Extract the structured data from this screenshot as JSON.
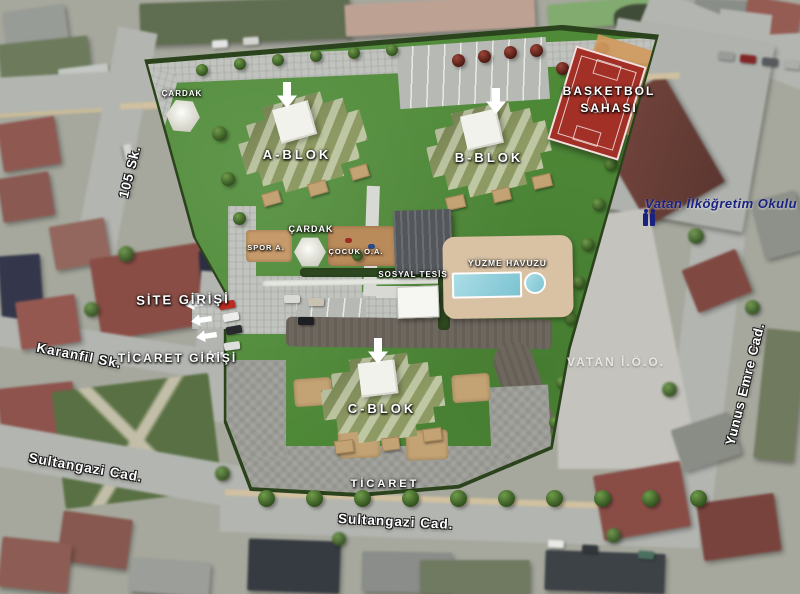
{
  "site_plan": {
    "blocks": [
      {
        "label": "A-BLOK"
      },
      {
        "label": "B-BLOK"
      },
      {
        "label": "C-BLOK"
      }
    ],
    "facilities": {
      "basketball_line1": "BASKETBOL",
      "basketball_line2": "SAHASI",
      "gazebo_northwest": "ÇARDAK",
      "gazebo_central": "ÇARDAK",
      "sports_area": "SPOR A.",
      "playground": "ÇOCUK O.A.",
      "social_facility": "SOSYAL TESİS",
      "swimming_pool": "YÜZME HAVUZU",
      "commerce_strip": "TİCARET"
    },
    "entrances": {
      "site": "SİTE GİRİŞİ",
      "commerce": "TİCARET GİRİŞİ"
    }
  },
  "surroundings": {
    "school_full_name": "Vatan İlköğretim Okulu",
    "school_abbr": "VATAN İ.Ö.O.",
    "streets": {
      "s105": "105 Sk.",
      "karanfil": "Karanfil Sk.",
      "sultangazi_west": "Sultangazi Cad.",
      "sultangazi_south": "Sultangazi Cad.",
      "yunus_emre": "Yunus Emre Cad."
    }
  },
  "icons": {
    "block_pointer": "down-arrow",
    "entrance_pointer": "left-arrow",
    "school_marker": "people-icon"
  },
  "colors": {
    "lawn_green": "#4e8a37",
    "hedge_green": "#2b431c",
    "court_red": "#a23026",
    "pool_blue": "#93d2de",
    "deck_tan": "#d9c2a4",
    "roof_olive": "#8d9a63",
    "school_label_navy": "#1a2280",
    "label_white": "#ffffff"
  }
}
